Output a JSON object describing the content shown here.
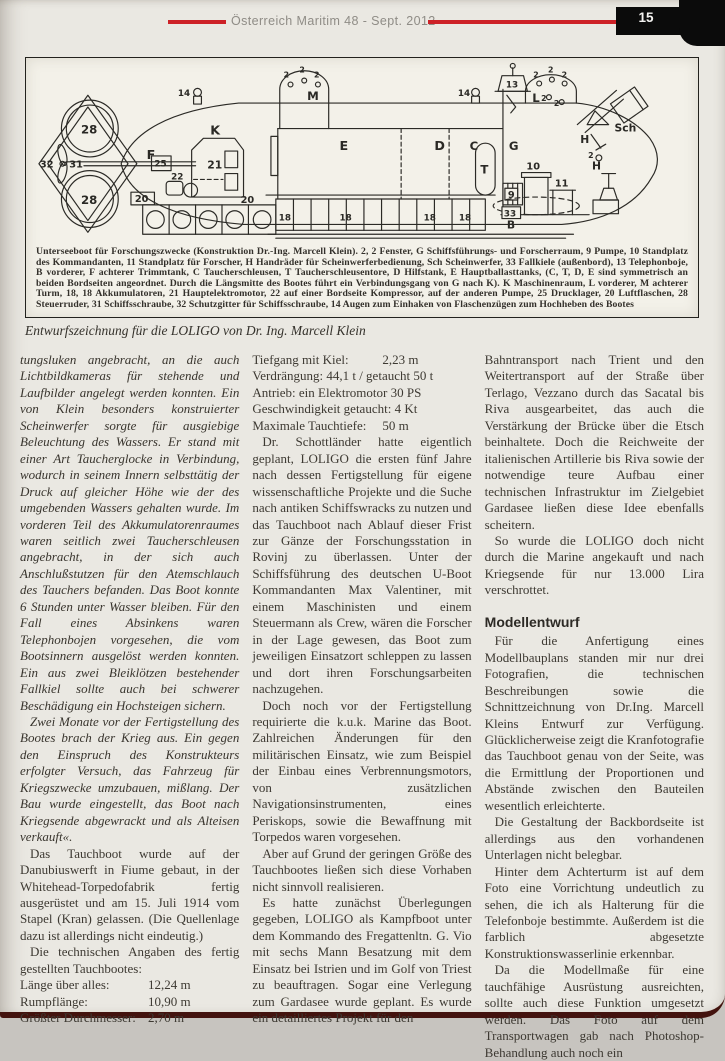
{
  "header": {
    "title": "Österreich Maritim  48 - Sept. 2012",
    "page_number": "15"
  },
  "figure": {
    "caption_block": "Unterseeboot für Forschungszwecke (Konstruktion Dr.-Ing. Marcell Klein). 2, 2 Fenster, G Schiffsführungs- und Forscherraum, 9 Pumpe, 10 Standplatz des Kommandanten, 11 Standplatz für Forscher, H Handräder für Scheinwerferbedienung, Sch Scheinwerfer, 33 Fallkiele (außenbord), 13 Telephonboje, B vorderer, F achterer Trimmtank, C Taucherschleusen, T Taucherschleusentore, D Hilfstank, E Hauptballasttanks, (C, T, D, E sind symmetrisch an beiden Bordseiten angeordnet. Durch die Längsmitte des Bootes führt ein Verbindungsgang von G nach K). K Maschinenraum, L vorderer, M achterer Turm, 18, 18 Akkumulatoren, 21 Hauptelektromotor, 22 auf einer Bordseite Kompressor, auf der anderen Pumpe, 25 Drucklager, 20 Luftflaschen, 28 Steuerruder, 31 Schiffsschraube, 32 Schutzgitter für Schiffsschraube, 14 Augen zum Einhaken von Flaschenzügen zum Hochheben des Bootes",
    "caption_italic": "Entwurfszeichnung für die LOLIGO von Dr. Ing. Marcell Klein",
    "diagram_labels": [
      {
        "t": "28",
        "x": 49,
        "y": 75,
        "fs": 12
      },
      {
        "t": "28",
        "x": 49,
        "y": 147,
        "fs": 12
      },
      {
        "t": "32",
        "x": 7,
        "y": 110,
        "fs": 10
      },
      {
        "t": "31",
        "x": 37,
        "y": 110,
        "fs": 10
      },
      {
        "t": "F",
        "x": 116,
        "y": 101,
        "fs": 13
      },
      {
        "t": "K",
        "x": 181,
        "y": 76,
        "fs": 13
      },
      {
        "t": "21",
        "x": 178,
        "y": 111,
        "fs": 11
      },
      {
        "t": "25",
        "x": 124,
        "y": 109,
        "fs": 9
      },
      {
        "t": "22",
        "x": 141,
        "y": 122,
        "fs": 9
      },
      {
        "t": "20",
        "x": 104,
        "y": 145,
        "fs": 10
      },
      {
        "t": "20",
        "x": 212,
        "y": 146,
        "fs": 10
      },
      {
        "t": "14",
        "x": 148,
        "y": 37,
        "fs": 9
      },
      {
        "t": "14",
        "x": 434,
        "y": 37,
        "fs": 9
      },
      {
        "t": "M",
        "x": 280,
        "y": 41,
        "fs": 12
      },
      {
        "t": "2",
        "x": 256,
        "y": 18,
        "fs": 8
      },
      {
        "t": "2",
        "x": 272,
        "y": 13,
        "fs": 8
      },
      {
        "t": "2",
        "x": 287,
        "y": 18,
        "fs": 8
      },
      {
        "t": "E",
        "x": 313,
        "y": 92,
        "fs": 13
      },
      {
        "t": "D",
        "x": 410,
        "y": 92,
        "fs": 13
      },
      {
        "t": "C",
        "x": 446,
        "y": 92,
        "fs": 12
      },
      {
        "t": "T",
        "x": 457,
        "y": 116,
        "fs": 12
      },
      {
        "t": "G",
        "x": 486,
        "y": 92,
        "fs": 12
      },
      {
        "t": "13",
        "x": 483,
        "y": 28,
        "fs": 9
      },
      {
        "t": "L",
        "x": 510,
        "y": 43,
        "fs": 12
      },
      {
        "t": "2",
        "x": 511,
        "y": 18,
        "fs": 8
      },
      {
        "t": "2",
        "x": 526,
        "y": 13,
        "fs": 8
      },
      {
        "t": "2",
        "x": 540,
        "y": 18,
        "fs": 8
      },
      {
        "t": "2",
        "x": 519,
        "y": 42,
        "fs": 8
      },
      {
        "t": "2",
        "x": 532,
        "y": 47,
        "fs": 8
      },
      {
        "t": "Sch",
        "x": 594,
        "y": 73,
        "fs": 11
      },
      {
        "t": "H",
        "x": 559,
        "y": 85,
        "fs": 11
      },
      {
        "t": "2",
        "x": 567,
        "y": 100,
        "fs": 8
      },
      {
        "t": "10",
        "x": 504,
        "y": 112,
        "fs": 10
      },
      {
        "t": "9",
        "x": 485,
        "y": 141,
        "fs": 10
      },
      {
        "t": "33",
        "x": 481,
        "y": 160,
        "fs": 9
      },
      {
        "t": "11",
        "x": 533,
        "y": 129,
        "fs": 10
      },
      {
        "t": "B",
        "x": 484,
        "y": 172,
        "fs": 11
      },
      {
        "t": "H",
        "x": 571,
        "y": 112,
        "fs": 11
      },
      {
        "t": "18",
        "x": 251,
        "y": 164,
        "fs": 9
      },
      {
        "t": "18",
        "x": 313,
        "y": 164,
        "fs": 9
      },
      {
        "t": "18",
        "x": 399,
        "y": 164,
        "fs": 9
      },
      {
        "t": "18",
        "x": 435,
        "y": 164,
        "fs": 9
      }
    ]
  },
  "columns": {
    "left": {
      "para_italic_1": "tungsluken angebracht, an die auch Lichtbildkameras für stehende und Laufbilder angelegt werden konnten. Ein von Klein besonders konstruierter Scheinwerfer sorgte für ausgiebige Beleuchtung des Wassers. Er stand mit einer Art Taucherglocke in Verbindung, wodurch in seinem Innern selbsttätig der Druck auf gleicher Höhe wie der des umgebenden Wassers gehalten wurde. Im vorderen Teil des Akkumulatorenraumes waren seitlich zwei Taucherschleusen angebracht, in der sich auch Anschlußstutzen für den Atemschlauch des Tauchers befanden. Das Boot konnte 6 Stunden unter Wasser bleiben. Für den Fall eines Absinkens waren Telephonbojen vorgesehen, die vom Bootsinnern ausgelöst werden konnten. Ein aus zwei Bleiklötzen bestehender Fallkiel sollte auch bei schwerer Beschädigung ein Hochsteigen sichern.",
      "para_italic_2": "Zwei Monate vor der Fertigstellung des Bootes brach der Krieg aus. Ein gegen den Einspruch des Konstrukteurs erfolgter Versuch, das Fahrzeug für Kriegszwecke umzubauen, mißlang. Der Bau wurde eingestellt, das Boot nach Kriegsende abgewrackt und als Alteisen verkauft«.",
      "para_1": "Das Tauchboot wurde auf der Danubiuswerft in Fiume gebaut, in der Whitehead-Torpedofabrik fertig ausgerüstet und am 15. Juli 1914 vom Stapel (Kran) gelassen. (Die Quellenlage dazu ist allerdings nicht eindeutig.)",
      "para_2": "Die technischen Angaben des fertig gestellten Tauchbootes:",
      "specs": [
        {
          "label": "Länge über alles:",
          "value": "12,24 m"
        },
        {
          "label": "Rumpflänge:",
          "value": "10,90 m"
        },
        {
          "label": "Größter Durchmesser:",
          "value": "2,70 m"
        }
      ]
    },
    "middle": {
      "specs": [
        {
          "label": "Tiefgang mit Kiel:",
          "value": "2,23 m"
        },
        {
          "label": "Verdrängung: 44,1 t / getaucht 50 t",
          "value": ""
        },
        {
          "label": "Antrieb: ein Elektromotor 30 PS",
          "value": ""
        },
        {
          "label": "Geschwindigkeit getaucht: 4 Kt",
          "value": ""
        },
        {
          "label": "Maximale Tauchtiefe:",
          "value": "50 m"
        }
      ],
      "para_1": "Dr. Schottländer hatte eigentlich geplant, LOLIGO die ersten fünf Jahre nach dessen Fertigstellung für eigene wissenschaftliche Projekte und die Suche nach antiken Schiffswracks zu nutzen und das Tauchboot nach Ablauf dieser Frist zur Gänze der Forschungsstation in Rovinj zu überlassen. Unter der Schiffsführung des deutschen U-Boot Kommandanten Max Valentiner, mit einem Maschinisten und einem Steuermann als Crew, wären die Forscher in der Lage gewesen, das Boot zum jeweiligen Einsatzort schleppen zu lassen und dort ihren Forschungsarbeiten nachzugehen.",
      "para_2": "Doch noch vor der Fertigstellung requirierte die k.u.k. Marine das Boot. Zahlreichen Änderungen für den militärischen Einsatz, wie zum Beispiel der Einbau eines Verbrennungsmotors, von zusätzlichen Navigationsinstrumenten, eines Periskops, sowie die Bewaffnung mit Torpedos waren vorgesehen.",
      "para_3": "Aber auf Grund der geringen Größe des Tauchbootes ließen sich diese Vorhaben nicht sinnvoll realisieren.",
      "para_4": "Es hatte zunächst Überlegungen gegeben, LOLIGO als Kampfboot unter dem Kommando des Fregattenltn. G. Vio mit sechs Mann Besatzung mit dem Einsatz bei Istrien und im Golf von Triest zu beauftragen. Sogar eine Verlegung zum Gardasee wurde geplant. Es wurde ein detailliertes Projekt für den"
    },
    "right": {
      "para_1": "Bahntransport nach Trient und den Weitertransport auf der Straße über Terlago, Vezzano durch das Sacatal bis Riva ausgearbeitet, das auch die Verstärkung der Brücke über die Etsch beinhaltete. Doch die Reichweite der italienischen Artillerie bis Riva sowie der notwendige teure Aufbau einer technischen Infrastruktur im Zielgebiet Gardasee ließen diese Idee ebenfalls scheitern.",
      "para_2": "So wurde die LOLIGO doch nicht durch die Marine angekauft und nach Kriegsende für nur 13.000 Lira verschrottet.",
      "heading": "Modellentwurf",
      "para_3": "Für die Anfertigung eines Modellbauplans standen mir nur drei Fotografien, die technischen Beschreibungen sowie die Schnittzeichnung von Dr.Ing. Marcell Kleins Entwurf zur Verfügung. Glücklicherweise zeigt die Kranfotografie das Tauchboot genau von der Seite, was die Ermittlung der Proportionen und Abstände zwischen den Bauteilen wesentlich erleichterte.",
      "para_4": "Die Gestaltung der Backbordseite ist allerdings aus den vorhandenen Unterlagen nicht belegbar.",
      "para_5": "Hinter dem Achterturm ist auf dem Foto eine Vorrichtung undeutlich zu sehen, die ich als Halterung für die Telefonboje bestimmte. Außerdem ist die farblich abgesetzte Konstruktionswasserlinie erkennbar.",
      "para_6": "Da die Modellmaße für eine tauchfähige Ausrüstung ausreichten, sollte auch diese Funktion umgesetzt werden. Das Foto auf dem Transportwagen gab nach Photoshop-Behandlung auch noch ein"
    }
  }
}
